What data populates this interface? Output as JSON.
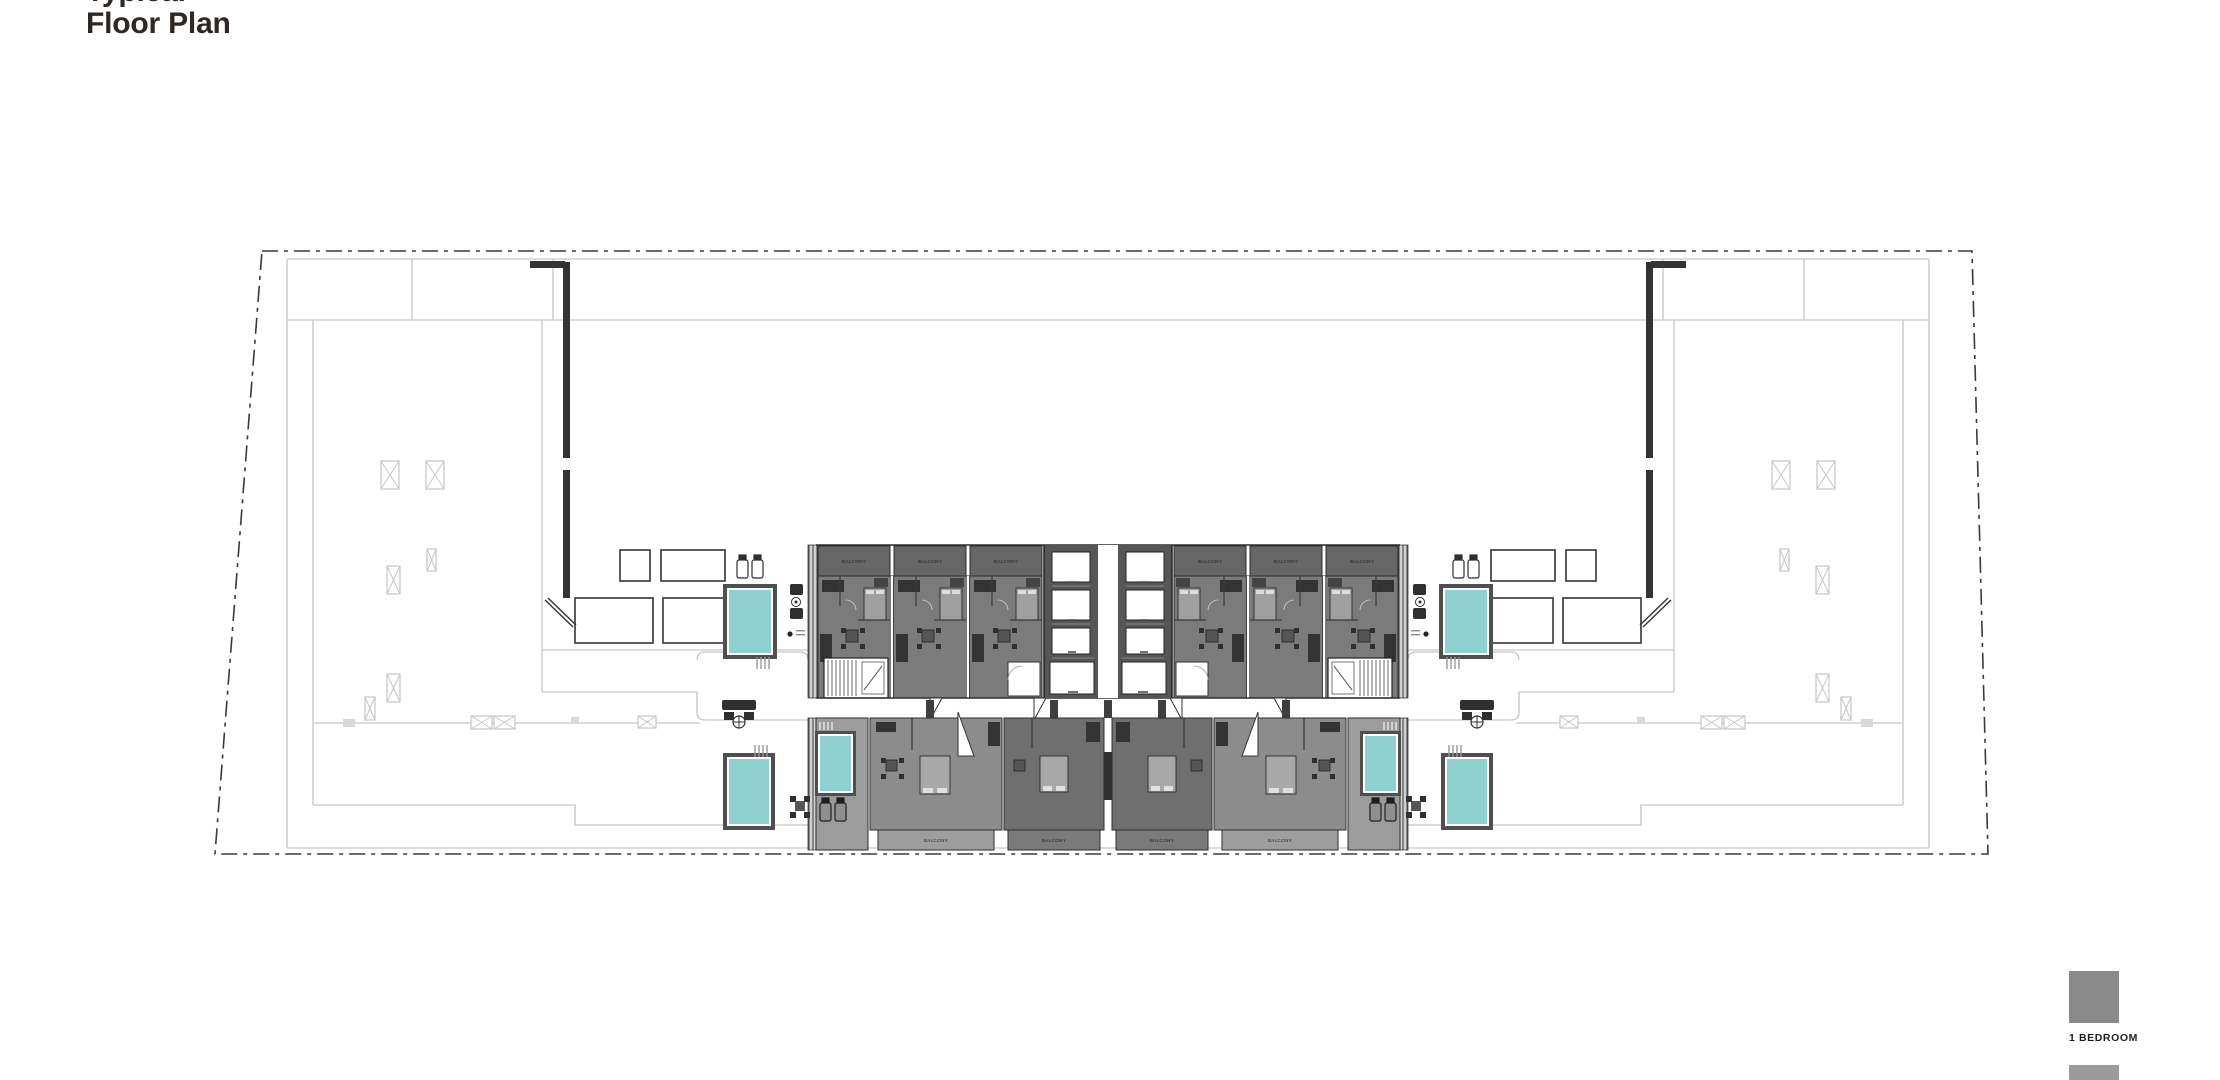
{
  "header": {
    "title": "Floor Plan",
    "title_partial": "Typical"
  },
  "plan": {
    "balcony_label": "BALCONY"
  },
  "legend": {
    "items": [
      {
        "label": "1 BEDROOM",
        "color": "#8A8A8A"
      }
    ],
    "partial_item_color": "#9B9B9B"
  },
  "colors": {
    "pool": "#8FD0D0",
    "unit_top": "#7B7B7B",
    "balcony_top": "#666666",
    "unit_bottom_outer": "#8C8C8C",
    "unit_bottom_inner": "#6F6F6F",
    "terrace": "#9C9C9C",
    "balcony_bottom_outer": "#9E9E9E",
    "balcony_bottom_inner": "#7A7A7A",
    "core": "#565656",
    "wall": "#333333",
    "furniture": "#2F2F2F",
    "outline": "#C6C6C6",
    "boundary": "#3A3A3A",
    "title_text": "#2E2724",
    "legend_1br": "#8A8A8A",
    "legend_partial": "#9B9B9B",
    "legend_text": "#1D1D1D"
  }
}
